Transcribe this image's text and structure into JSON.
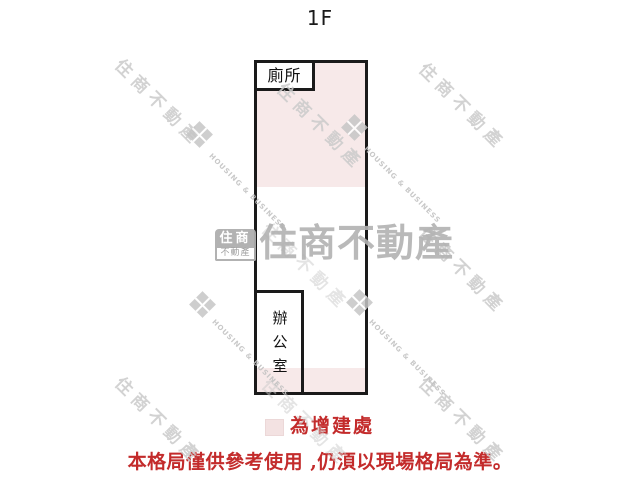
{
  "title": "1F",
  "plan": {
    "toilet_label": "廁所",
    "office_label": "辦公室"
  },
  "legend": {
    "label": "為增建處"
  },
  "disclaimer": "本格局僅供參考使用 ,仍湏以現場格局為準。",
  "watermark": {
    "brand": "住商不動產",
    "brand_en": "HOUSING & BUSINESS",
    "logo_top": "住商",
    "logo_bottom": "不動產"
  },
  "colors": {
    "annex_fill": "#f7e9e9",
    "wall": "#1a1a1a",
    "accent_red": "#c32b2b",
    "watermark_gray": "#bdbdbd"
  }
}
